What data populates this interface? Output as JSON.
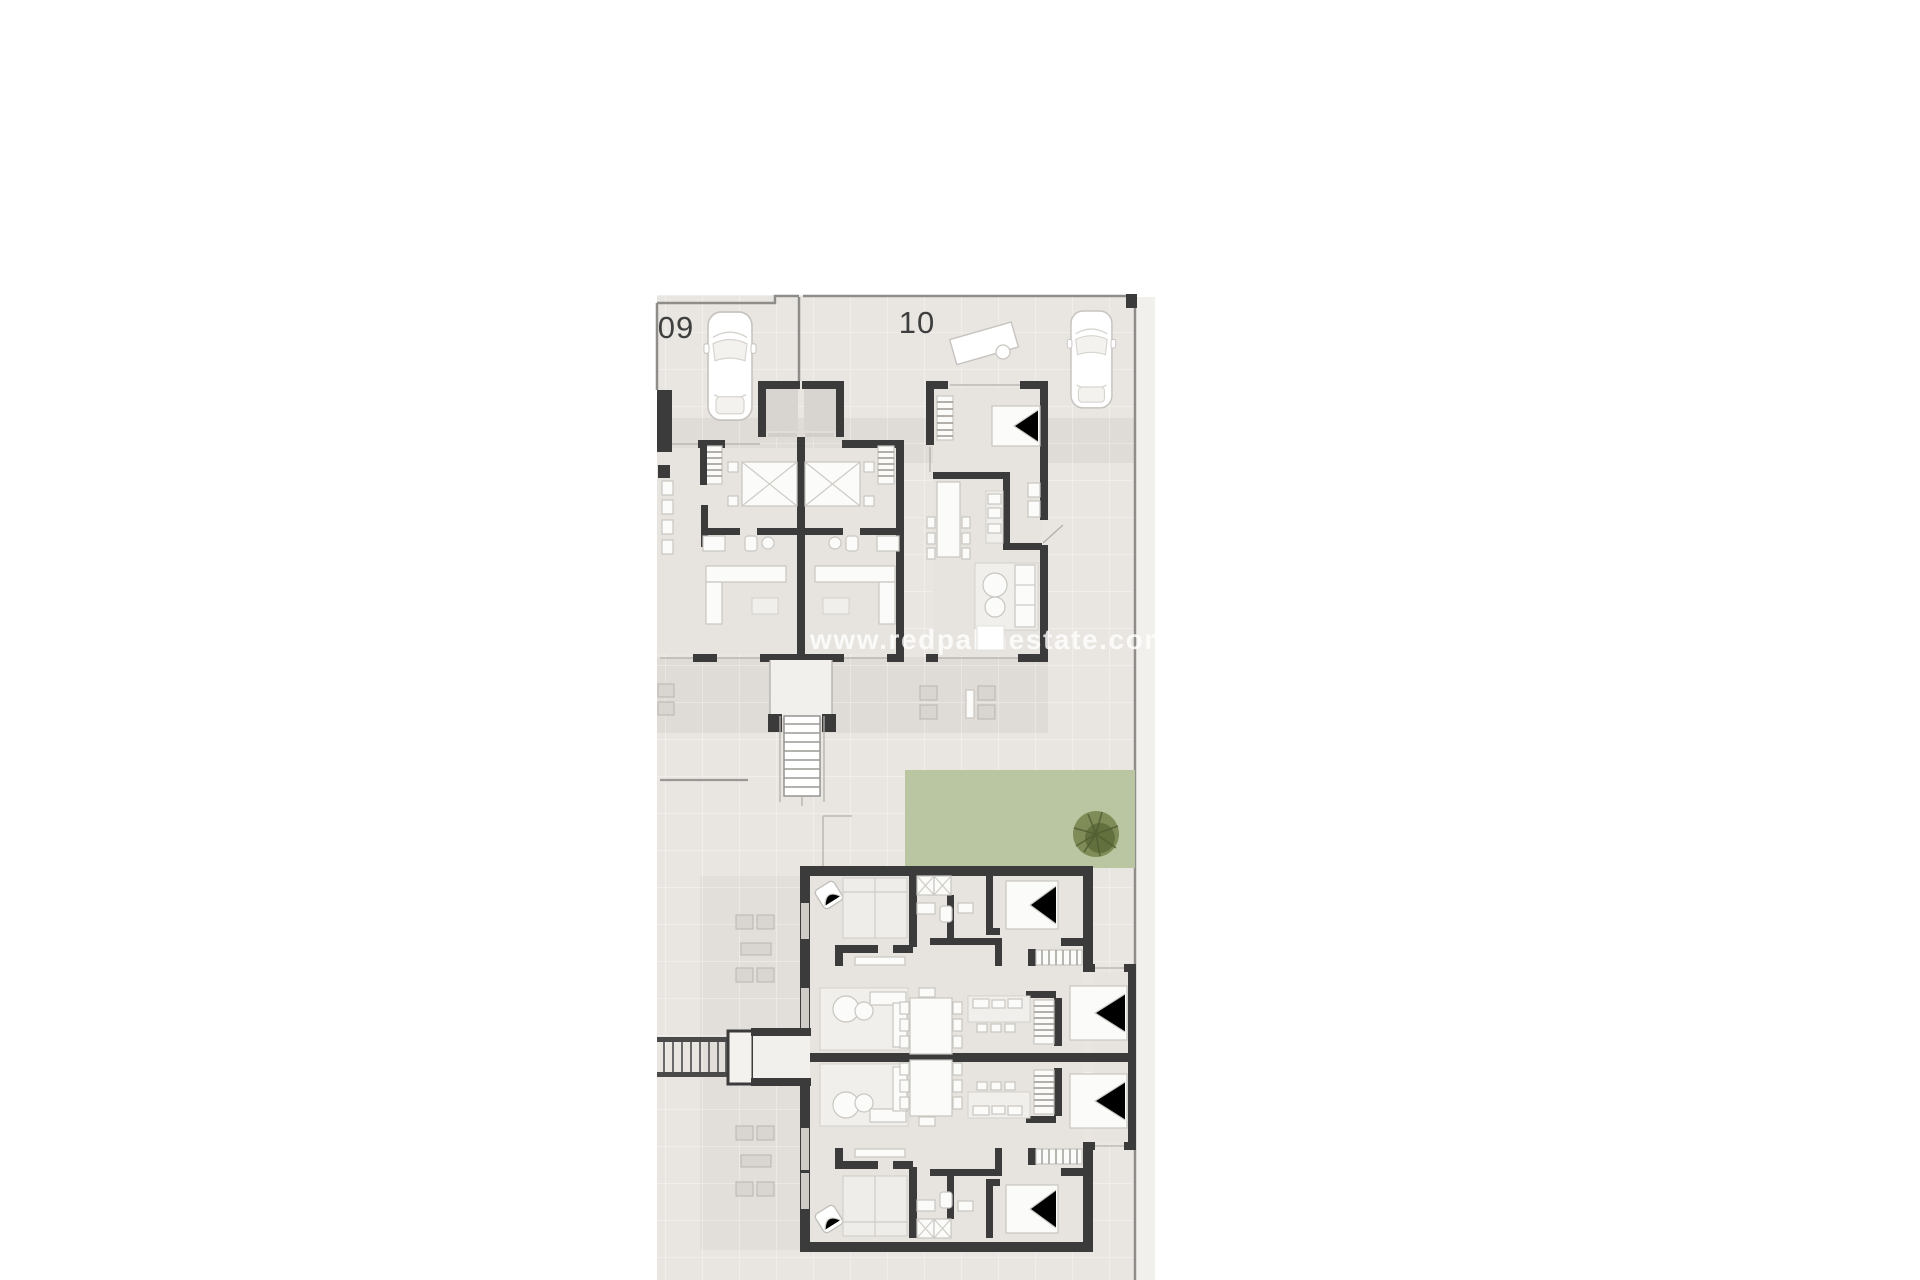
{
  "page": {
    "width": 1920,
    "height": 1280,
    "background": "#ffffff"
  },
  "plan": {
    "kind": "architectural-floor-plan",
    "watermark": "www.redpalmestate.com",
    "units": [
      {
        "id": "unit-09",
        "label": "09"
      },
      {
        "id": "unit-10",
        "label": "10"
      }
    ],
    "objects": {
      "car_icon": "top-down parked car",
      "palm_tree_icon": "garden palm tree",
      "stair_icon": "external staircase",
      "bed_icon": "double bed",
      "sofa_icon": "living-room sofa",
      "dining_table_icon": "dining table with chairs",
      "kitchen_icon": "kitchen counter"
    },
    "colors": {
      "pavement": "#e9e6e2",
      "pavement_light": "#f2f0ec",
      "driveway_band": "#dfdbd6",
      "terrace_band": "#e2deda",
      "floor": "#e7e4df",
      "porch_floor": "#d8d5d0",
      "room_white": "#fbfbf9",
      "rug": "#f1efeb",
      "wall_dark": "#3b3b3b",
      "thin_line": "#8f8d8a",
      "furniture_gray": "#d9d6d1",
      "grass_green": "#b5c29a",
      "tree_green": "#6d7b48",
      "label_text": "#3f3f3f",
      "watermark_white": "#ffffff"
    }
  }
}
